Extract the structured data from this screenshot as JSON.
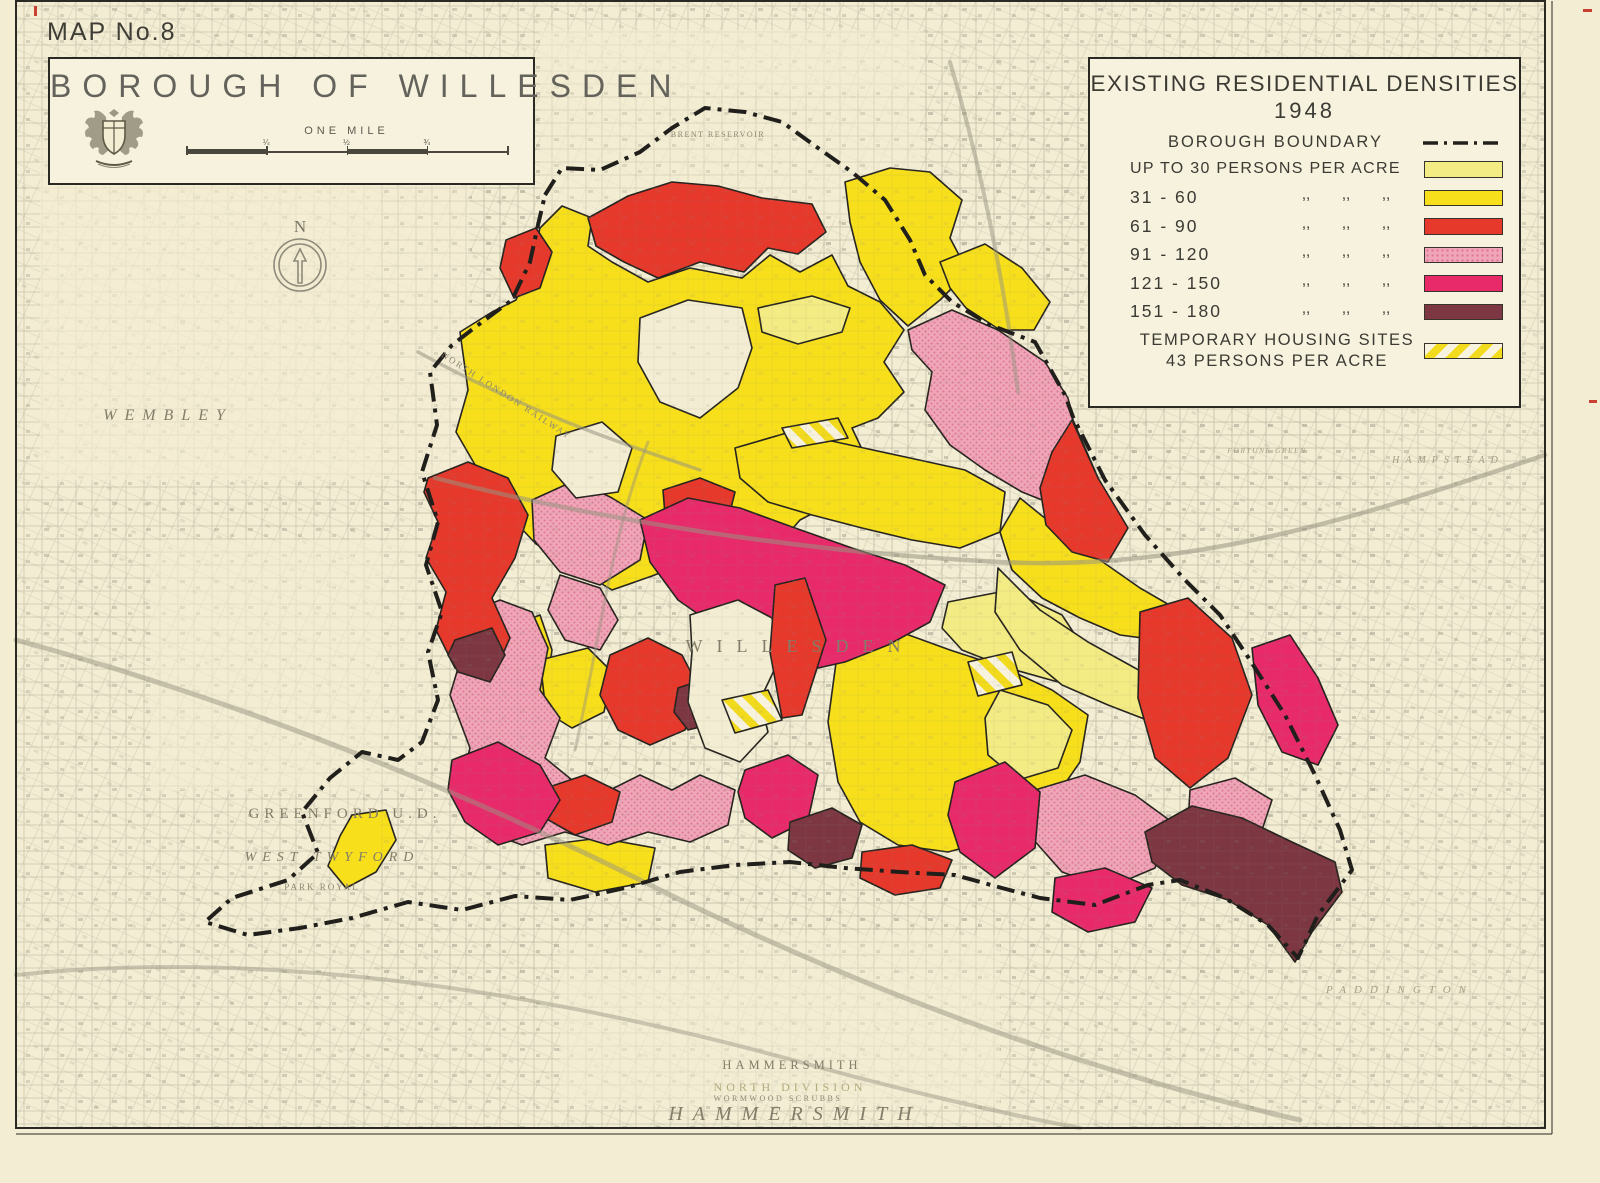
{
  "sheet": {
    "number_label": "MAP No.8"
  },
  "title_box": {
    "title": "BOROUGH OF WILLESDEN",
    "scale_label": "ONE MILE",
    "scale_ticks": [
      "¼",
      "½",
      "¾"
    ],
    "coat_of_arms_icon": "willesden-crest"
  },
  "legend": {
    "title": "EXISTING RESIDENTIAL DENSITIES",
    "year": "1948",
    "boundary_label": "BOROUGH BOUNDARY",
    "ditto_mark": ",,",
    "rows": [
      {
        "label": "UP TO 30 PERSONS PER ACRE",
        "ditto": false,
        "swatch": "pale_yellow"
      },
      {
        "label": "31  -  60",
        "ditto": true,
        "swatch": "yellow"
      },
      {
        "label": "61  -  90",
        "ditto": true,
        "swatch": "red"
      },
      {
        "label": "91  -  120",
        "ditto": true,
        "swatch": "pink"
      },
      {
        "label": "121  -  150",
        "ditto": true,
        "swatch": "magenta"
      },
      {
        "label": "151  -  180",
        "ditto": true,
        "swatch": "maroon"
      }
    ],
    "temp_housing": {
      "line1": "TEMPORARY HOUSING SITES",
      "line2": "43  PERSONS  PER  ACRE",
      "swatch": "stripes"
    }
  },
  "compass": {
    "label": "N"
  },
  "palette": {
    "paper": "#F3EDD3",
    "box_fill": "#F7F2DE",
    "pale_yellow": "#F3EB83",
    "yellow": "#F7DF1B",
    "red": "#E6382B",
    "pink": "#F0A6B8",
    "pink_dot": "#DD7693",
    "magenta": "#E82A6B",
    "maroon": "#7C3742",
    "boundary": "#211F1B",
    "map_line": "#8E8A7A",
    "stripe_bg": "#F8F3DE",
    "stripe_fg": "#F2DB1C",
    "reg_mark": "#C8402F",
    "title_text": "#63625B",
    "legend_text": "#3B3A33"
  },
  "map_labels": [
    {
      "text": "WEMBLEY",
      "x": 168,
      "y": 420,
      "size": 16,
      "ls": 8,
      "rot": 0,
      "cls": "ml-serifi"
    },
    {
      "text": "NORTH LONDON RAILWAY",
      "x": 505,
      "y": 398,
      "size": 9,
      "ls": 2,
      "rot": 33,
      "cls": "ml-tiny"
    },
    {
      "text": "BRENT RESERVOIR",
      "x": 718,
      "y": 137,
      "size": 8,
      "ls": 1.5,
      "rot": 0,
      "cls": "ml-tiny"
    },
    {
      "text": "GREENFORD U.D.",
      "x": 345,
      "y": 818,
      "size": 15,
      "ls": 5,
      "rot": 0,
      "cls": "ml-serif"
    },
    {
      "text": "WEST TWYFORD",
      "x": 332,
      "y": 861,
      "size": 14,
      "ls": 6,
      "rot": 0,
      "cls": "ml-serifi"
    },
    {
      "text": "PARK ROYAL",
      "x": 322,
      "y": 890,
      "size": 9,
      "ls": 2,
      "rot": 0,
      "cls": "ml-tiny"
    },
    {
      "text": "WILLESDEN",
      "x": 800,
      "y": 652,
      "size": 18,
      "ls": 14,
      "rot": 0,
      "cls": "ml-serif"
    },
    {
      "text": "HAMMERSMITH",
      "x": 792,
      "y": 1069,
      "size": 12.5,
      "ls": 4,
      "rot": 0,
      "cls": "ml-serif"
    },
    {
      "text": "NORTH DIVISION",
      "x": 790,
      "y": 1091,
      "size": 12,
      "ls": 7,
      "rot": 0,
      "cls": "ml-olive"
    },
    {
      "text": "WORMWOOD  SCRUBBS",
      "x": 778,
      "y": 1101,
      "size": 8,
      "ls": 2.5,
      "rot": 0,
      "cls": "ml-tiny"
    },
    {
      "text": "HAMMERSMITH",
      "x": 795,
      "y": 1120,
      "size": 20,
      "ls": 10,
      "rot": 0,
      "cls": "ml-serifi"
    },
    {
      "text": "PADDINGTON",
      "x": 1400,
      "y": 993,
      "size": 11,
      "ls": 8,
      "rot": 0,
      "cls": "ml-faint"
    },
    {
      "text": "HAMPSTEAD",
      "x": 1448,
      "y": 463,
      "size": 10,
      "ls": 6,
      "rot": 0,
      "cls": "ml-faint"
    },
    {
      "text": "FORTUNE GREEN",
      "x": 1267,
      "y": 453,
      "size": 7.5,
      "ls": 1.5,
      "rot": 0,
      "cls": "ml-faint"
    }
  ]
}
